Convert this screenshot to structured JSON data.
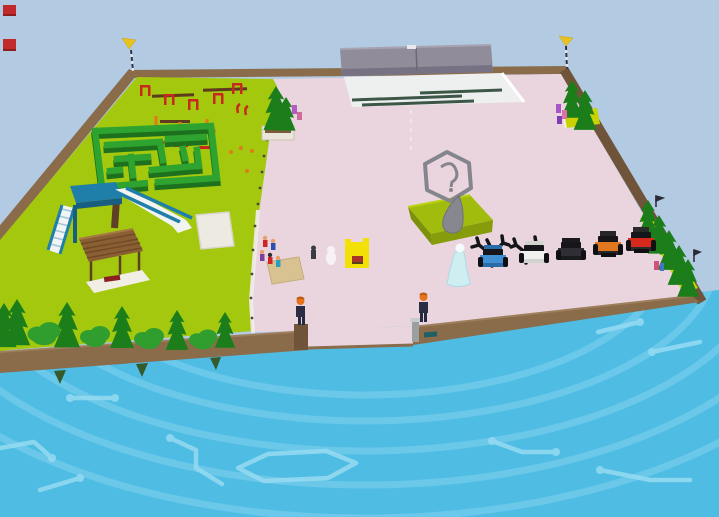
{
  "scene": {
    "name": "floating-island-park",
    "view": "isometric-3d-game-world"
  },
  "hud": {
    "markers": [
      {
        "name": "red-marker-top"
      },
      {
        "name": "red-marker-bottom"
      }
    ]
  },
  "colors": {
    "sky": "#b2cae2",
    "water": "#4fbce4",
    "water_ring": "#82d2ee",
    "water_trace": "#96dbf2",
    "grass": "#a3c80d",
    "grass_strip": "#c9d303",
    "hedge_top": "#2fa32f",
    "hedge_side": "#1d701d",
    "tree_dark": "#1b7e1b",
    "tree_mid": "#2f9e2f",
    "border": "#8a6b4a",
    "border_dark": "#705439",
    "border_lip": "#9d7f5c",
    "floor": "#ead5df",
    "floor_light": "#f3ecef",
    "stage_floor": "#eef0f0",
    "stage_stripe": "#2a4735",
    "canopy": "#908c9a",
    "canopy_dark": "#767283",
    "mound": "#a2bc0e",
    "mound_side": "#879c0b",
    "mound_shade": "#7d900a",
    "logo": "#85858d",
    "statue_gray": "#87878f",
    "booth_yellow": "#f2e006",
    "flag_yellow": "#e8c31e",
    "npc_orange": "#e5731c",
    "npc_body": "#262a40",
    "mat_tan": "#d9c292",
    "mat_white": "#edeae2",
    "obstacle_red": "#c9281e",
    "obstacle_orange": "#e07a1a",
    "obstacle_brown": "#5e3a1e",
    "slide_blue": "#1f7fa8",
    "slide_blue_dark": "#175e80",
    "slide_white": "#f2f4f4",
    "pavilion_wood": "#8a5f33",
    "pavilion_dark": "#5e4026",
    "character_cyan": "#cfeef2",
    "pillar_gray": "#9aa0a0",
    "dark_tree": "#141419",
    "teal_box": "#1f5f66",
    "marker_red": "#c02a2a"
  },
  "objects": {
    "vehicles": [
      {
        "name": "blue-car",
        "color": "#3f8fd2",
        "shade": "#2a6ca8"
      },
      {
        "name": "white-car",
        "color": "#f0f0ee",
        "shade": "#d2d2d0"
      },
      {
        "name": "black-car",
        "color": "#2e2e34",
        "shade": "#1a1a1e"
      },
      {
        "name": "orange-truck",
        "color": "#e07820",
        "shade": "#26262a"
      },
      {
        "name": "red-truck",
        "color": "#d4291c",
        "shade": "#2a2a2a"
      }
    ],
    "structures": [
      {
        "name": "stage-canopy"
      },
      {
        "name": "hex-logo-monument"
      },
      {
        "name": "hedge-maze"
      },
      {
        "name": "playground-slide"
      },
      {
        "name": "wooden-pavilion"
      },
      {
        "name": "yellow-booth"
      },
      {
        "name": "obstacle-course"
      }
    ],
    "characters": [
      {
        "name": "visitor-left"
      },
      {
        "name": "visitor-right"
      },
      {
        "name": "cyan-queen"
      },
      {
        "name": "ghost-figure"
      },
      {
        "name": "npc-group-left"
      }
    ],
    "flags": [
      {
        "name": "corner-flag-left"
      },
      {
        "name": "corner-flag-right"
      }
    ]
  }
}
